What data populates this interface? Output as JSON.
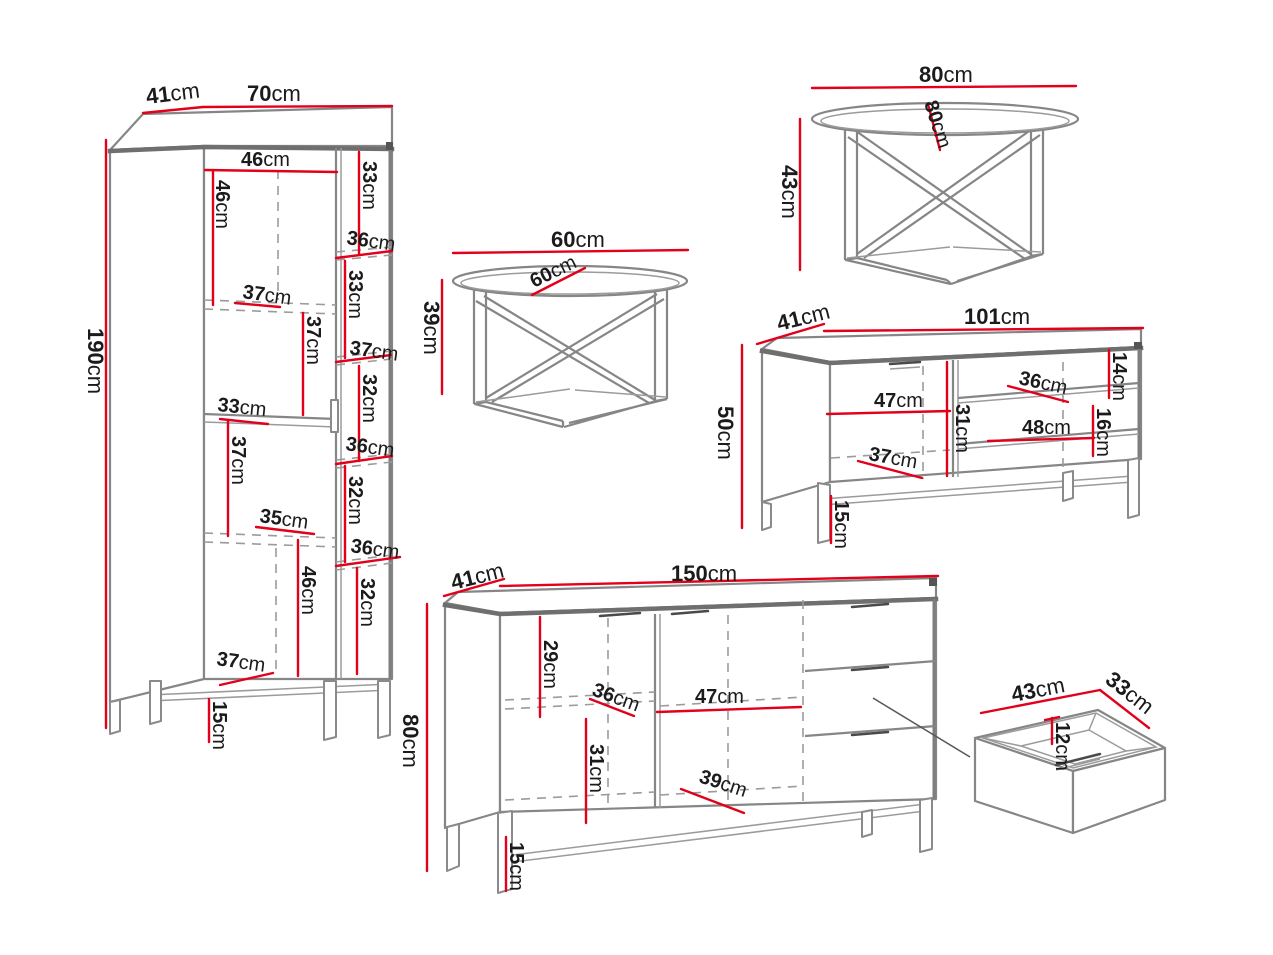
{
  "unit": "cm",
  "pieces": {
    "wardrobe": {
      "depth": "41",
      "width": "70",
      "height": "190",
      "leg_height": "15",
      "left_column": [
        "46",
        "46",
        "37",
        "37",
        "33",
        "37",
        "35",
        "46",
        "37"
      ],
      "right_column": [
        "33",
        "36",
        "33",
        "37",
        "32",
        "36",
        "32",
        "36",
        "32"
      ]
    },
    "coffee_table_small": {
      "width": "60",
      "diameter": "60",
      "height": "39"
    },
    "coffee_table_large": {
      "width": "80",
      "diameter": "80",
      "height": "43"
    },
    "tv_stand": {
      "depth": "41",
      "width": "101",
      "height": "50",
      "door_width": "47",
      "door_height": "31",
      "door_shelf": "37",
      "top_shelf_depth": "36",
      "top_shelf_height": "14",
      "bottom_shelf_width": "48",
      "bottom_shelf_height": "16",
      "leg_height": "15"
    },
    "sideboard": {
      "depth": "41",
      "width": "150",
      "height": "80",
      "left_top": "29",
      "left_shelf": "36",
      "left_bottom": "31",
      "middle_width": "47",
      "middle_shelf": "39",
      "leg_height": "15"
    },
    "drawer": {
      "width": "43",
      "depth": "33",
      "height": "12"
    }
  }
}
